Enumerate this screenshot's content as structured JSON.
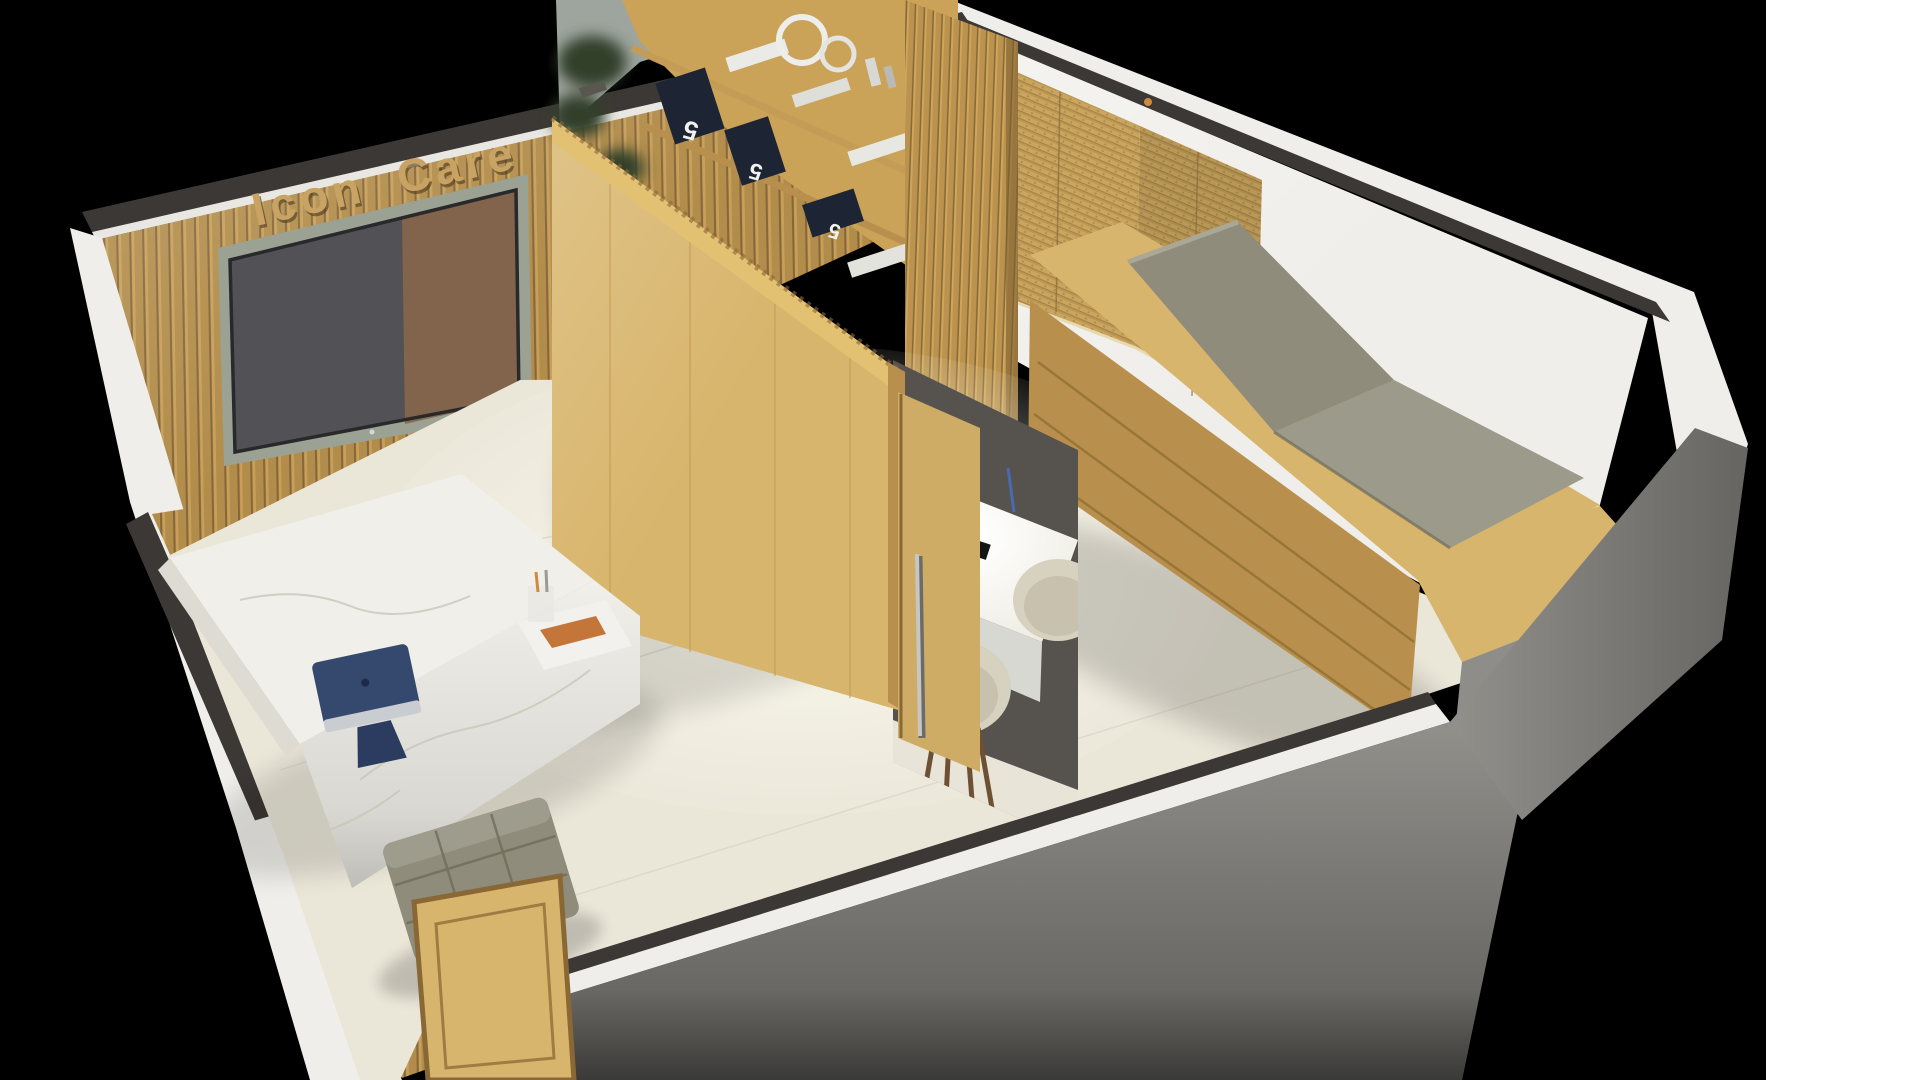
{
  "sign": {
    "text": "Icon Care"
  },
  "shelf": {
    "book_labels": [
      "5",
      "5",
      "5"
    ]
  },
  "palette": {
    "background": "#000000",
    "page_margin": "#ffffff",
    "wall_white": "#efeeea",
    "wall_cut_gray": "#91908b",
    "trim_dark": "#3c3835",
    "wood_light": "#d8b56c",
    "wood_dark": "#b98f4e",
    "wood_slat": "#b28c4a",
    "bamboo_blind": "#c9a55e",
    "floor_cream": "#eae6d8",
    "cushion_olive": "#8f8c7b",
    "marble_white": "#f0efe9",
    "imac_navy": "#35486e",
    "tv_screen_gray": "#525156",
    "sign_gold": "#c8a364",
    "book_navy": "#1d2434",
    "plant_green": "#33412b",
    "chair_beige": "#d7d1bf",
    "desk_glow_white": "#fbfbf6"
  }
}
